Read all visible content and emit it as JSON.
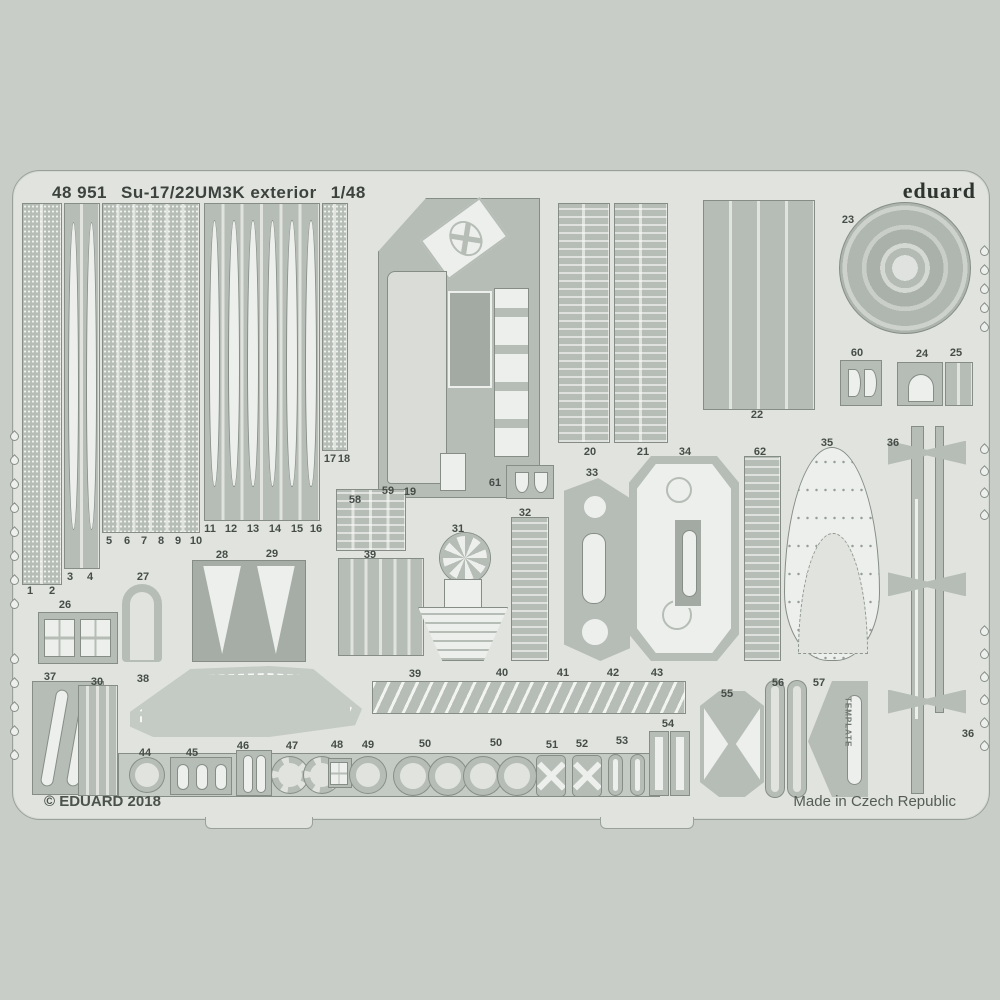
{
  "header": {
    "catalog_number": "48 951",
    "title": "Su-17/22UM3K exterior",
    "scale": "1/48",
    "brand": "eduard"
  },
  "footer": {
    "copyright": "© EDUARD 2018",
    "made_in": "Made in Czech Republic"
  },
  "template_label": "TEMPLATE",
  "colors": {
    "background": "#c9cdc8",
    "plate": "#e0e3de",
    "part": "#b6bcb6",
    "cutout": "#edefec",
    "text": "#3f4642"
  },
  "part_labels": [
    {
      "n": "1",
      "x": 30,
      "y": 591
    },
    {
      "n": "2",
      "x": 52,
      "y": 591
    },
    {
      "n": "3",
      "x": 70,
      "y": 577
    },
    {
      "n": "4",
      "x": 90,
      "y": 577
    },
    {
      "n": "5",
      "x": 109,
      "y": 541
    },
    {
      "n": "6",
      "x": 127,
      "y": 541
    },
    {
      "n": "7",
      "x": 144,
      "y": 541
    },
    {
      "n": "8",
      "x": 161,
      "y": 541
    },
    {
      "n": "9",
      "x": 178,
      "y": 541
    },
    {
      "n": "10",
      "x": 196,
      "y": 541
    },
    {
      "n": "11",
      "x": 210,
      "y": 529
    },
    {
      "n": "12",
      "x": 231,
      "y": 529
    },
    {
      "n": "13",
      "x": 253,
      "y": 529
    },
    {
      "n": "14",
      "x": 275,
      "y": 529
    },
    {
      "n": "15",
      "x": 297,
      "y": 529
    },
    {
      "n": "16",
      "x": 316,
      "y": 529
    },
    {
      "n": "17",
      "x": 330,
      "y": 459
    },
    {
      "n": "18",
      "x": 344,
      "y": 459
    },
    {
      "n": "19",
      "x": 410,
      "y": 492
    },
    {
      "n": "20",
      "x": 590,
      "y": 452
    },
    {
      "n": "21",
      "x": 643,
      "y": 452
    },
    {
      "n": "22",
      "x": 757,
      "y": 415
    },
    {
      "n": "23",
      "x": 848,
      "y": 220
    },
    {
      "n": "60",
      "x": 857,
      "y": 353
    },
    {
      "n": "24",
      "x": 922,
      "y": 354
    },
    {
      "n": "25",
      "x": 956,
      "y": 353
    },
    {
      "n": "26",
      "x": 65,
      "y": 605
    },
    {
      "n": "27",
      "x": 143,
      "y": 577
    },
    {
      "n": "28",
      "x": 222,
      "y": 555
    },
    {
      "n": "29",
      "x": 272,
      "y": 554
    },
    {
      "n": "58",
      "x": 355,
      "y": 500
    },
    {
      "n": "59",
      "x": 388,
      "y": 491
    },
    {
      "n": "61",
      "x": 495,
      "y": 483
    },
    {
      "n": "31",
      "x": 458,
      "y": 529
    },
    {
      "n": "32",
      "x": 525,
      "y": 513
    },
    {
      "n": "33",
      "x": 592,
      "y": 473
    },
    {
      "n": "34",
      "x": 685,
      "y": 452
    },
    {
      "n": "62",
      "x": 760,
      "y": 452
    },
    {
      "n": "35",
      "x": 827,
      "y": 443
    },
    {
      "n": "36",
      "x": 893,
      "y": 443
    },
    {
      "n": "37",
      "x": 50,
      "y": 677
    },
    {
      "n": "30",
      "x": 97,
      "y": 682
    },
    {
      "n": "38",
      "x": 143,
      "y": 679
    },
    {
      "n": "39",
      "x": 370,
      "y": 555
    },
    {
      "n": "39",
      "x": 415,
      "y": 674
    },
    {
      "n": "40",
      "x": 502,
      "y": 673
    },
    {
      "n": "41",
      "x": 563,
      "y": 673
    },
    {
      "n": "42",
      "x": 613,
      "y": 673
    },
    {
      "n": "43",
      "x": 657,
      "y": 673
    },
    {
      "n": "44",
      "x": 145,
      "y": 753
    },
    {
      "n": "45",
      "x": 192,
      "y": 753
    },
    {
      "n": "46",
      "x": 243,
      "y": 746
    },
    {
      "n": "47",
      "x": 292,
      "y": 746
    },
    {
      "n": "48",
      "x": 337,
      "y": 745
    },
    {
      "n": "49",
      "x": 368,
      "y": 745
    },
    {
      "n": "50",
      "x": 425,
      "y": 744
    },
    {
      "n": "50",
      "x": 496,
      "y": 743
    },
    {
      "n": "51",
      "x": 552,
      "y": 745
    },
    {
      "n": "52",
      "x": 582,
      "y": 744
    },
    {
      "n": "53",
      "x": 622,
      "y": 741
    },
    {
      "n": "54",
      "x": 668,
      "y": 724
    },
    {
      "n": "55",
      "x": 727,
      "y": 694
    },
    {
      "n": "56",
      "x": 778,
      "y": 683
    },
    {
      "n": "57",
      "x": 819,
      "y": 683
    },
    {
      "n": "36",
      "x": 968,
      "y": 734
    }
  ],
  "shapes": [
    {
      "name": "strip-group-1-2",
      "kind": "strips",
      "x": 22,
      "y": 203,
      "w": 40,
      "h": 382,
      "lanes": 2,
      "tex": "dots"
    },
    {
      "name": "strip-group-3-4",
      "kind": "strips",
      "x": 64,
      "y": 203,
      "w": 36,
      "h": 366,
      "lanes": 2,
      "blades": 2
    },
    {
      "name": "strip-group-5-10",
      "kind": "strips",
      "x": 102,
      "y": 203,
      "w": 98,
      "h": 330,
      "lanes": 6,
      "tex": "dots"
    },
    {
      "name": "strip-group-11-16",
      "kind": "strips",
      "x": 204,
      "y": 203,
      "w": 116,
      "h": 318,
      "lanes": 6,
      "blades": 6
    },
    {
      "name": "strip-group-17-18",
      "kind": "strips",
      "x": 322,
      "y": 203,
      "w": 26,
      "h": 248,
      "lanes": 2,
      "tex": "dots"
    },
    {
      "name": "fuselage-panel-19",
      "kind": "panel19",
      "x": 378,
      "y": 198,
      "w": 162,
      "h": 300
    },
    {
      "name": "strip-group-20",
      "kind": "ladder",
      "x": 558,
      "y": 203,
      "w": 52,
      "h": 240,
      "lanes": 2
    },
    {
      "name": "strip-group-21",
      "kind": "ladder",
      "x": 614,
      "y": 203,
      "w": 54,
      "h": 240,
      "lanes": 2
    },
    {
      "name": "strip-group-22",
      "kind": "strips",
      "x": 703,
      "y": 200,
      "w": 112,
      "h": 210,
      "lanes": 4
    },
    {
      "name": "wheel-disc-23",
      "kind": "disc",
      "x": 839,
      "y": 202,
      "w": 132,
      "h": 132
    },
    {
      "name": "part-60",
      "kind": "dshapes",
      "x": 840,
      "y": 360,
      "w": 42,
      "h": 46
    },
    {
      "name": "part-24",
      "kind": "arch",
      "x": 897,
      "y": 362,
      "w": 46,
      "h": 44
    },
    {
      "name": "part-25",
      "kind": "strips",
      "x": 945,
      "y": 362,
      "w": 28,
      "h": 44,
      "lanes": 2
    },
    {
      "name": "part-26",
      "kind": "grid",
      "x": 38,
      "y": 612,
      "w": 80,
      "h": 52,
      "cells": 2
    },
    {
      "name": "part-27",
      "kind": "ushape",
      "x": 122,
      "y": 584,
      "w": 40,
      "h": 78
    },
    {
      "name": "part-28-29",
      "kind": "vblades",
      "x": 192,
      "y": 560,
      "w": 114,
      "h": 102
    },
    {
      "name": "part-58-59",
      "kind": "ladder",
      "x": 336,
      "y": 489,
      "w": 70,
      "h": 62,
      "lanes": 4
    },
    {
      "name": "part-39-strips",
      "kind": "strips",
      "x": 338,
      "y": 558,
      "w": 86,
      "h": 98,
      "lanes": 6
    },
    {
      "name": "part-31",
      "kind": "fan",
      "x": 413,
      "y": 533,
      "w": 98,
      "h": 128
    },
    {
      "name": "part-32",
      "kind": "ladder",
      "x": 511,
      "y": 517,
      "w": 38,
      "h": 144,
      "lanes": 1
    },
    {
      "name": "part-61",
      "kind": "dshapes",
      "x": 506,
      "y": 465,
      "w": 48,
      "h": 34
    },
    {
      "name": "part-33",
      "kind": "ovalpanel",
      "x": 564,
      "y": 478,
      "w": 66,
      "h": 183
    },
    {
      "name": "part-34",
      "kind": "hexpanel",
      "x": 629,
      "y": 456,
      "w": 110,
      "h": 205
    },
    {
      "name": "part-62",
      "kind": "ladder",
      "x": 744,
      "y": 456,
      "w": 37,
      "h": 205,
      "lanes": 1
    },
    {
      "name": "part-35",
      "kind": "teardrop",
      "x": 784,
      "y": 447,
      "w": 96,
      "h": 214
    },
    {
      "name": "pitot-probe-36",
      "kind": "probe",
      "x": 888,
      "y": 426,
      "w": 78,
      "h": 366
    },
    {
      "name": "part-37",
      "kind": "slantbars",
      "x": 32,
      "y": 681,
      "w": 72,
      "h": 114
    },
    {
      "name": "part-30",
      "kind": "strips",
      "x": 78,
      "y": 685,
      "w": 40,
      "h": 111,
      "lanes": 4
    },
    {
      "name": "wing-part-38",
      "kind": "wing",
      "x": 130,
      "y": 666,
      "w": 232,
      "h": 74
    },
    {
      "name": "strip-39-43",
      "kind": "toothstrip",
      "x": 372,
      "y": 681,
      "w": 314,
      "h": 33
    },
    {
      "name": "bottom-band",
      "kind": "band",
      "x": 118,
      "y": 753,
      "w": 542,
      "h": 44
    },
    {
      "name": "ring-44",
      "kind": "ring",
      "x": 130,
      "y": 758,
      "w": 34,
      "h": 34
    },
    {
      "name": "clips-45",
      "kind": "clips",
      "x": 170,
      "y": 757,
      "w": 62,
      "h": 38
    },
    {
      "name": "bars-46",
      "kind": "slotpair",
      "x": 236,
      "y": 750,
      "w": 36,
      "h": 46
    },
    {
      "name": "ring-47a",
      "kind": "ring",
      "x": 272,
      "y": 757,
      "w": 36,
      "h": 36,
      "dotted": true
    },
    {
      "name": "ring-47b",
      "kind": "ring",
      "x": 304,
      "y": 757,
      "w": 36,
      "h": 36,
      "dotted": true
    },
    {
      "name": "part-48",
      "kind": "grid",
      "x": 328,
      "y": 758,
      "w": 24,
      "h": 30,
      "cells": 1
    },
    {
      "name": "ring-49",
      "kind": "ring",
      "x": 350,
      "y": 757,
      "w": 36,
      "h": 36
    },
    {
      "name": "ring-50a",
      "kind": "ring",
      "x": 394,
      "y": 757,
      "w": 38,
      "h": 38
    },
    {
      "name": "ring-50b",
      "kind": "ring",
      "x": 429,
      "y": 757,
      "w": 38,
      "h": 38
    },
    {
      "name": "ring-50c",
      "kind": "ring",
      "x": 464,
      "y": 757,
      "w": 38,
      "h": 38
    },
    {
      "name": "ring-50d",
      "kind": "ring",
      "x": 498,
      "y": 757,
      "w": 38,
      "h": 38
    },
    {
      "name": "buckle-51",
      "kind": "buckle",
      "x": 536,
      "y": 755,
      "w": 30,
      "h": 42
    },
    {
      "name": "buckle-52",
      "kind": "buckle",
      "x": 572,
      "y": 755,
      "w": 30,
      "h": 42
    },
    {
      "name": "clip-53a",
      "kind": "ovalclip",
      "x": 608,
      "y": 754,
      "w": 15,
      "h": 42
    },
    {
      "name": "clip-53b",
      "kind": "ovalclip",
      "x": 630,
      "y": 754,
      "w": 15,
      "h": 42
    },
    {
      "name": "rectring-54a",
      "kind": "rectring",
      "x": 650,
      "y": 732,
      "w": 18,
      "h": 63
    },
    {
      "name": "rectring-54b",
      "kind": "rectring",
      "x": 671,
      "y": 732,
      "w": 18,
      "h": 63
    },
    {
      "name": "part-55",
      "kind": "hexprism",
      "x": 700,
      "y": 691,
      "w": 64,
      "h": 106
    },
    {
      "name": "slotring-56a",
      "kind": "slotring",
      "x": 766,
      "y": 681,
      "w": 18,
      "h": 116
    },
    {
      "name": "slotring-56b",
      "kind": "slotring",
      "x": 788,
      "y": 681,
      "w": 18,
      "h": 116
    },
    {
      "name": "template-57",
      "kind": "template",
      "x": 808,
      "y": 681,
      "w": 60,
      "h": 116
    }
  ],
  "droplet_columns": [
    {
      "x": 14,
      "ys": [
        432,
        456,
        480,
        504,
        528,
        552,
        576,
        600
      ]
    },
    {
      "x": 14,
      "ys": [
        655,
        679,
        703,
        727,
        751
      ]
    },
    {
      "x": 984,
      "ys": [
        247,
        266,
        285,
        304,
        323
      ]
    },
    {
      "x": 984,
      "ys": [
        445,
        467,
        489,
        511
      ]
    },
    {
      "x": 984,
      "ys": [
        627,
        650,
        673,
        696,
        719,
        742
      ]
    }
  ]
}
